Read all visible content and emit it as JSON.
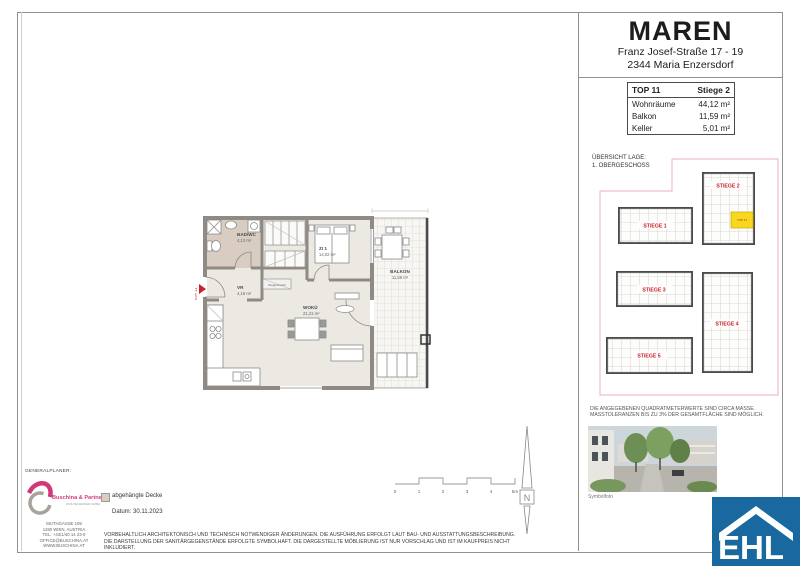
{
  "sheet": {
    "project": "MAREN",
    "address_line1": "Franz Josef-Straße 17 - 19",
    "address_line2": "2344  Maria Enzersdorf"
  },
  "unit_table": {
    "unit": "TOP 11",
    "stiege": "Stiege 2",
    "rows": [
      {
        "label": "Wohnräume",
        "value": "44,12 m²"
      },
      {
        "label": "Balkon",
        "value": "11,59 m²"
      },
      {
        "label": "Keller",
        "value": "5,01 m²"
      }
    ]
  },
  "overview": {
    "heading_line1": "ÜBERSICHT LAGE:",
    "heading_line2": "1. OBERGESCHOSS",
    "buildings": [
      {
        "label": "STIEGE 2"
      },
      {
        "label": "STIEGE 1"
      },
      {
        "label": "STIEGE 3"
      },
      {
        "label": "STIEGE 4"
      },
      {
        "label": "STIEGE 5"
      }
    ],
    "highlight_unit": "TOP 11",
    "note_line1": "DIE ANGEGEBENEN QUADRATMETERWERTE SIND CIRCA MASSE.",
    "note_line2": "MASSTOLERANZEN BIS ZU 3% DER GESAMTFLÄCHE SIND MÖGLICH.",
    "photo_caption": "Symbolfoto"
  },
  "floorplan": {
    "unit_label": "TOP 11",
    "rooms": [
      {
        "name": "BAD/WC",
        "area": "4,13 m²"
      },
      {
        "name": "ZI 1",
        "area": "14,02 m²"
      },
      {
        "name": "VR",
        "area": "4,16 m²"
      },
      {
        "name": "WOKÜ",
        "area": "21,21 m²"
      },
      {
        "name": "BALKON",
        "area": "11,59 m²"
      }
    ],
    "shaft_label": "Steigschacht"
  },
  "generalplaner": {
    "heading": "GENERALPLANER:",
    "company": "Buschina & Partner",
    "company_sub": "ZIVILTECHNIKER GMBH",
    "address": [
      "MUTHGASSE 109",
      "1190 WIEN, AUSTRIA",
      "TEL: +43/1/40 14 23-0",
      "OFFICE@BUSCHINA.AT",
      "WWW.BUSCHINA.AT"
    ]
  },
  "legend": {
    "ceiling_label": "abgehängte Decke",
    "date_label": "Datum: 30.11.2023"
  },
  "disclaimer": {
    "line1": "VORBEHALTLICH ARCHITEKTONISCH UND TECHNISCH NOTWENDIGER ÄNDERUNGEN. DIE AUSFÜHRUNG ERFOLGT LAUT BAU- UND AUSSTATTUNGSBESCHREIBUNG.",
    "line2": "DIE DARSTELLUNG DER SANITÄRGEGENSTÄNDE ERFOLGTE SYMBOLHAFT. DIE DARGESTELLTE MÖBLIERUNG IST NUR VORSCHLAG UND IST IM KAUFPREIS NICHT INKLUDIERT."
  },
  "scalebar": {
    "labels": [
      "0",
      "1",
      "2",
      "3",
      "4",
      "5m"
    ]
  },
  "north_label": "N",
  "brand": {
    "logo_text": "EHL"
  },
  "colors": {
    "accent_red": "#cc2127",
    "highlight_yellow": "#f7d821",
    "boundary_pink": "#e9a8cb",
    "ceiling_beige": "#d8cdc0",
    "ehl_blue": "#19689f",
    "buschina_pink": "#d13a7a"
  }
}
